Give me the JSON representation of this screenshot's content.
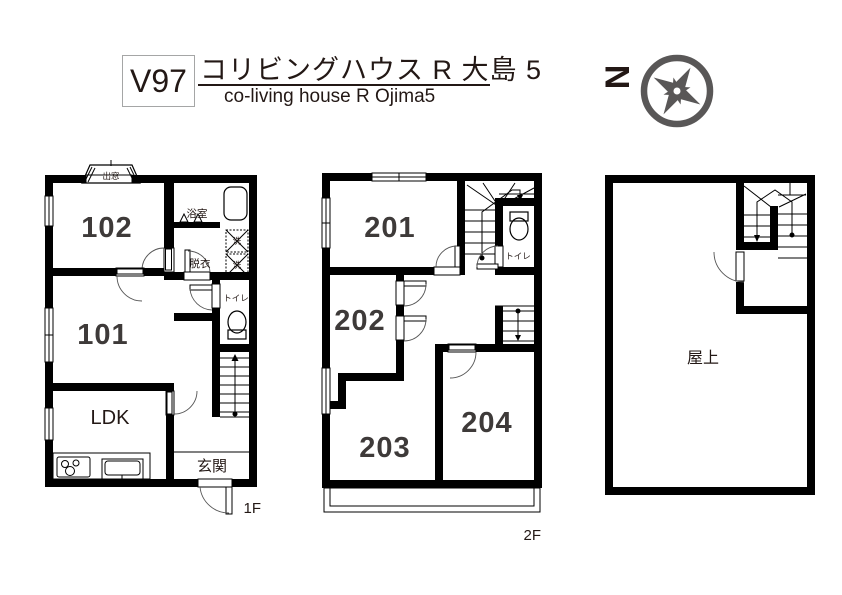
{
  "header": {
    "plan_code": "V97",
    "title_jp": "コリビングハウス R 大島 5",
    "title_en": "co-living house R Ojima5",
    "north_label": "N"
  },
  "floor1": {
    "floor_label": "1F",
    "room_102": "102",
    "room_101": "101",
    "ldk": "LDK",
    "entrance": "玄関",
    "bathroom": "浴室",
    "dressing": "脱衣",
    "toilet": "トイレ",
    "bay_window": "出窓",
    "washer": "洗"
  },
  "floor2": {
    "floor_label": "2F",
    "room_201": "201",
    "room_202": "202",
    "room_203": "203",
    "room_204": "204",
    "toilet": "トイレ"
  },
  "roof": {
    "rooftop": "屋上"
  },
  "colors": {
    "wall": "#000000",
    "title_text": "#231815",
    "room_text": "#3e3a39",
    "north_red": "#c30d23",
    "compass_gray": "#595757"
  }
}
